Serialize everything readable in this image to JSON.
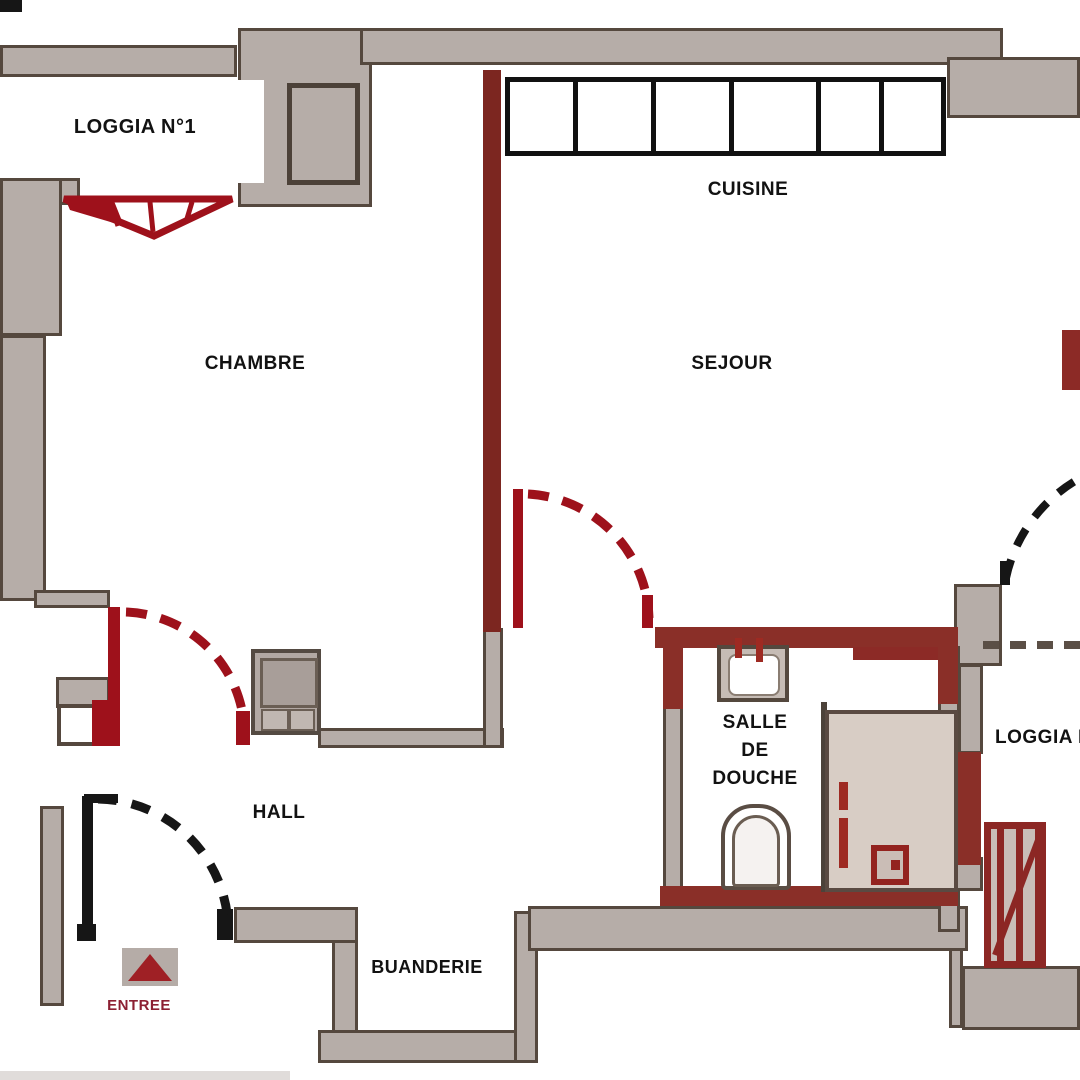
{
  "plan": {
    "title": "Apartment floor plan",
    "rooms": {
      "loggia1": {
        "label": "LOGGIA N°1"
      },
      "cuisine": {
        "label": "CUISINE"
      },
      "chambre": {
        "label": "CHAMBRE"
      },
      "sejour": {
        "label": "SEJOUR"
      },
      "salle_de_douche": {
        "lines": [
          "SALLE",
          "DE",
          "DOUCHE"
        ]
      },
      "hall": {
        "label": "HALL"
      },
      "buanderie": {
        "label": "BUANDERIE"
      },
      "loggia2": {
        "label": "LOGGIA N"
      },
      "entree": {
        "label": "ENTREE"
      }
    },
    "fixtures": {
      "kitchen_counter_cells": 6,
      "cell_flex": [
        68,
        79,
        80,
        88,
        63,
        62
      ]
    },
    "colors": {
      "wall_gray": "#b6ada8",
      "wall_outline": "#55483e",
      "partition_red": "#7c2620",
      "bath_red": "#8a2f28",
      "door_red": "#9e111b",
      "door_black": "#161616",
      "entree_text": "#8c2033",
      "counter_black": "#111111"
    }
  }
}
